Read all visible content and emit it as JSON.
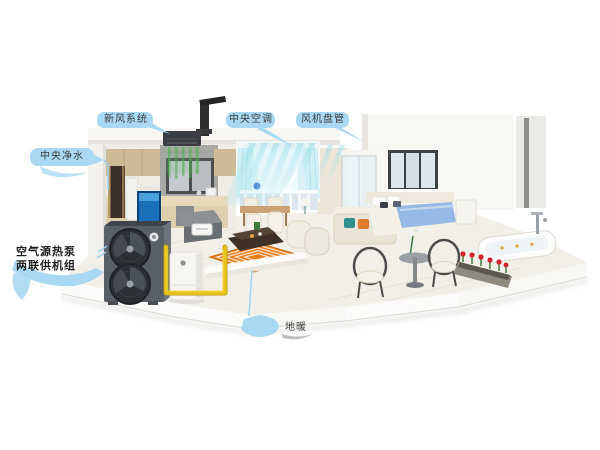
{
  "callouts": {
    "fresh_air": {
      "label": "新风系统"
    },
    "central_ac": {
      "label": "中央空调"
    },
    "fan_coil": {
      "label": "风机盘管"
    },
    "water_purification": {
      "label": "中央净水"
    },
    "heat_pump": {
      "label_line1": "空气源热泵",
      "label_line2": "两联供机组"
    },
    "floor_heating": {
      "label": "地暖"
    }
  },
  "colors": {
    "callout_bubble": "#a9d9f2",
    "callout_text": "#3b3b3b",
    "cool_airflow": "#7fd4e4",
    "fresh_airflow": "#4db04d",
    "floor_heating_mat": "#e67e1a",
    "water_pipe": "#e6c41c",
    "heat_pump_body": "#595f66"
  }
}
